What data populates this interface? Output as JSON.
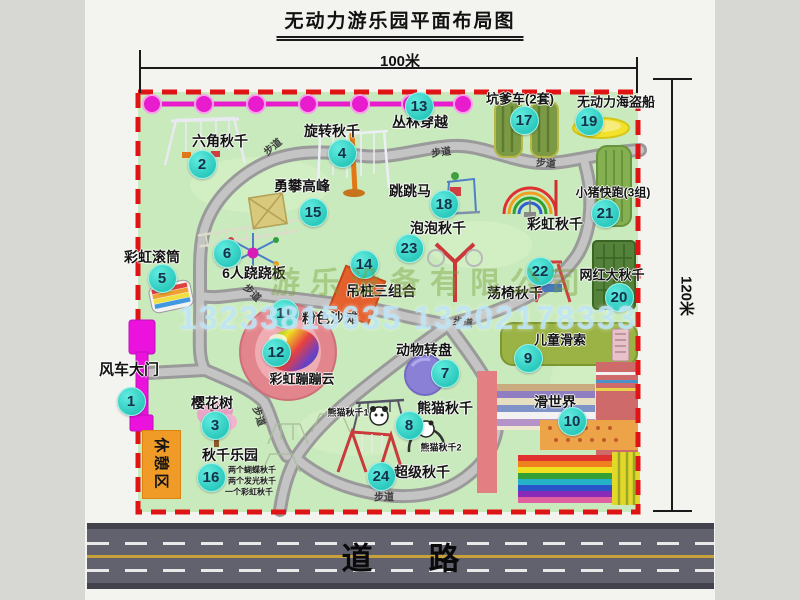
{
  "title": "无动力游乐园平面布局图",
  "dimensions": {
    "width": "100米",
    "height": "120米"
  },
  "road": {
    "label": "道路"
  },
  "rest_area": {
    "label": "休憩区"
  },
  "watermark": {
    "company": "游乐设备有限公司",
    "phone": "13233815635 13202178333"
  },
  "colors": {
    "map_fill": "#c9eabc",
    "boundary_red": "#e01414",
    "marker_cyan": "#2cc9bd",
    "gate_magenta": "#ea12dc",
    "zipline_magenta": "#e81ccc",
    "road_gray": "#62626e",
    "rest_orange": "#f09b28",
    "path_gray": "#9a9a9a"
  },
  "map": {
    "pois": [
      {
        "num": "1",
        "name": "风车大门",
        "nx": 130,
        "ny": 400,
        "lx": 129,
        "ly": 369,
        "fs": 15
      },
      {
        "num": "2",
        "name": "六角秋千",
        "nx": 201,
        "ny": 163,
        "lx": 220,
        "ly": 141
      },
      {
        "num": "3",
        "name": "樱花树",
        "nx": 214,
        "ny": 424,
        "lx": 212,
        "ly": 403
      },
      {
        "num": "4",
        "name": "旋转秋千",
        "nx": 341,
        "ny": 152,
        "lx": 332,
        "ly": 131
      },
      {
        "num": "5",
        "name": "彩虹滚筒",
        "nx": 161,
        "ny": 277,
        "lx": 152,
        "ly": 257
      },
      {
        "num": "6",
        "name": "6人跷跷板",
        "nx": 226,
        "ny": 252,
        "lx": 254,
        "ly": 273
      },
      {
        "num": "7",
        "name": "动物转盘",
        "nx": 444,
        "ny": 372,
        "lx": 424,
        "ly": 350
      },
      {
        "num": "8",
        "name": "熊猫秋千",
        "nx": 408,
        "ny": 424,
        "lx": 445,
        "ly": 408
      },
      {
        "num": "9",
        "name": "儿童滑索",
        "nx": 527,
        "ny": 357,
        "lx": 560,
        "ly": 339,
        "fs": 13
      },
      {
        "num": "10",
        "name": "滑世界",
        "nx": 571,
        "ny": 420,
        "lx": 555,
        "ly": 402
      },
      {
        "num": "11",
        "name": "粉色沙滩",
        "nx": 283,
        "ny": 312,
        "lx": 330,
        "ly": 318
      },
      {
        "num": "12",
        "name": "彩虹蹦蹦云",
        "nx": 275,
        "ny": 351,
        "lx": 302,
        "ly": 378,
        "fs": 13
      },
      {
        "num": "13",
        "name": "丛林穿越",
        "nx": 418,
        "ny": 105,
        "lx": 420,
        "ly": 122
      },
      {
        "num": "14",
        "name": "吊桩三组合",
        "nx": 363,
        "ny": 263,
        "lx": 381,
        "ly": 291
      },
      {
        "num": "15",
        "name": "勇攀高峰",
        "nx": 312,
        "ny": 211,
        "lx": 302,
        "ly": 186
      },
      {
        "num": "16",
        "name": "秋千乐园",
        "nx": 210,
        "ny": 476,
        "lx": 230,
        "ly": 455
      },
      {
        "num": "17",
        "name": "坑爹车(2套)",
        "nx": 523,
        "ny": 119,
        "lx": 520,
        "ly": 98,
        "fs": 13
      },
      {
        "num": "18",
        "name": "跳跳马",
        "nx": 443,
        "ny": 203,
        "lx": 410,
        "ly": 191
      },
      {
        "num": "19",
        "name": "无动力海盗船",
        "nx": 588,
        "ny": 120,
        "lx": 616,
        "ly": 101,
        "fs": 13
      },
      {
        "num": "20",
        "name": "网红大秋千",
        "nx": 618,
        "ny": 296,
        "lx": 612,
        "ly": 274,
        "fs": 13
      },
      {
        "num": "21",
        "name": "小猪快跑(3组)",
        "nx": 604,
        "ny": 212,
        "lx": 613,
        "ly": 192,
        "fs": 12
      },
      {
        "num": "22",
        "name": "荡椅秋千",
        "nx": 539,
        "ny": 270,
        "lx": 515,
        "ly": 293
      },
      {
        "num": "23",
        "name": "泡泡秋千",
        "nx": 408,
        "ny": 247,
        "lx": 438,
        "ly": 228
      },
      {
        "num": "24",
        "name": "超级秋千",
        "nx": 380,
        "ny": 475,
        "lx": 422,
        "ly": 472
      }
    ],
    "extra_labels": [
      {
        "text": "彩虹秋千",
        "x": 555,
        "y": 224,
        "fs": 14
      },
      {
        "text": "熊猫秋千1",
        "x": 348,
        "y": 412,
        "fs": 9
      },
      {
        "text": "熊猫秋千2",
        "x": 441,
        "y": 447,
        "fs": 9
      }
    ],
    "path_labels": [
      {
        "text": "步道",
        "x": 272,
        "y": 146,
        "rot": -40
      },
      {
        "text": "步道",
        "x": 441,
        "y": 151,
        "rot": -8
      },
      {
        "text": "步道",
        "x": 546,
        "y": 162,
        "rot": 4
      },
      {
        "text": "步道",
        "x": 253,
        "y": 292,
        "rot": 45
      },
      {
        "text": "步道",
        "x": 463,
        "y": 321,
        "rot": 8
      },
      {
        "text": "步道",
        "x": 260,
        "y": 416,
        "rot": 72
      },
      {
        "text": "步道",
        "x": 384,
        "y": 496,
        "rot": 0
      }
    ],
    "swing_park_notes": [
      {
        "text": "两个蝴蝶秋千",
        "x": 252,
        "y": 470
      },
      {
        "text": "两个发光秋千",
        "x": 252,
        "y": 481
      },
      {
        "text": "一个彩虹秋千",
        "x": 249,
        "y": 492
      }
    ]
  }
}
